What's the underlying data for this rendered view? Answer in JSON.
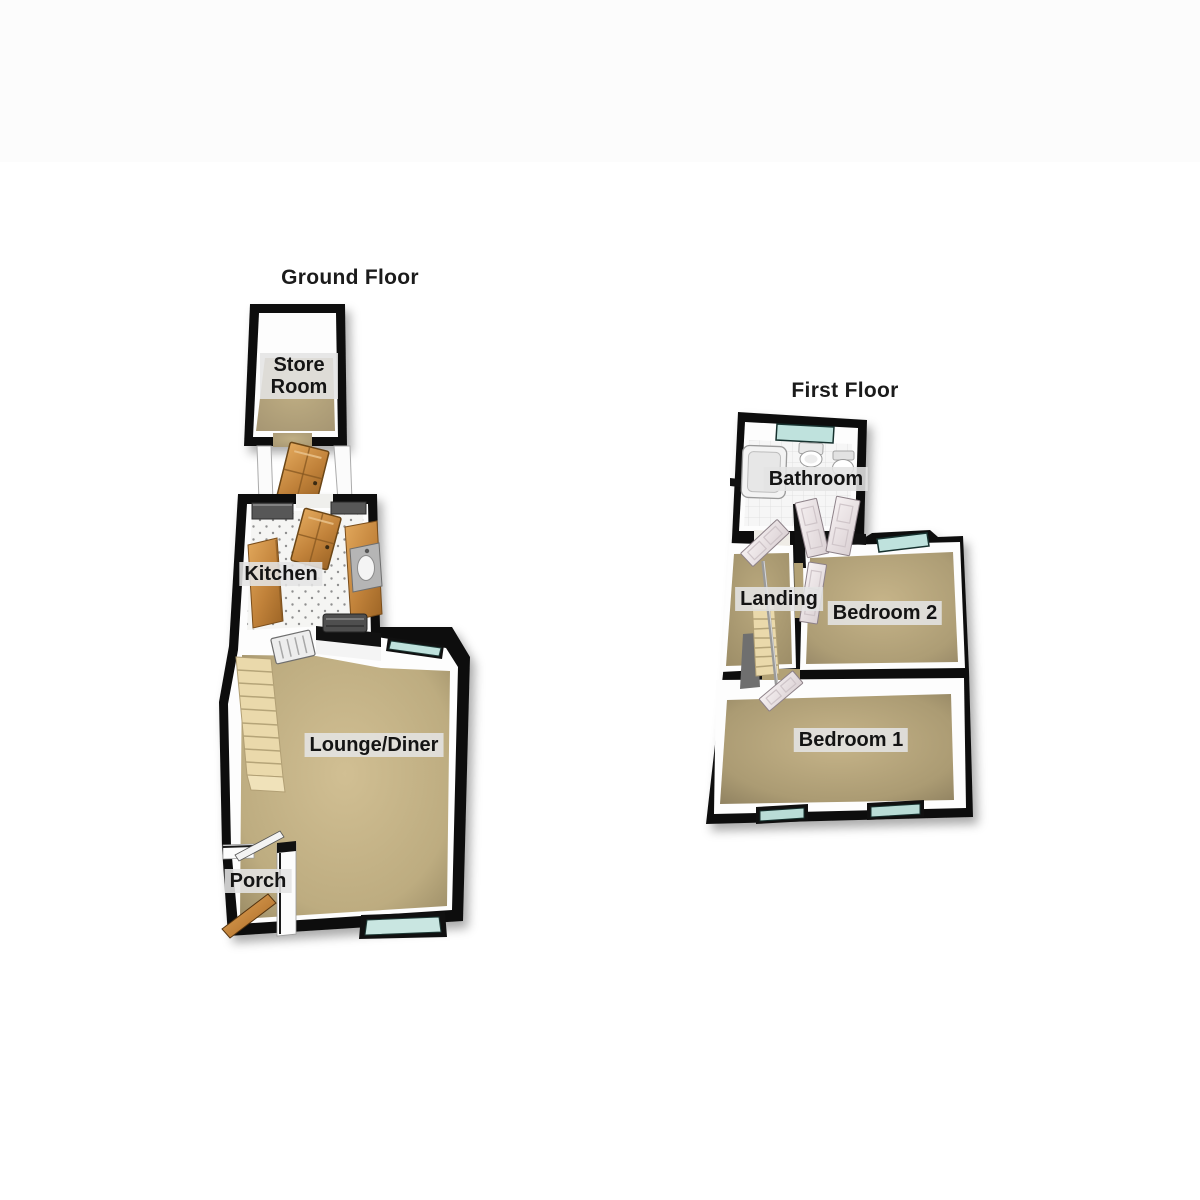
{
  "page": {
    "background": "#ffffff"
  },
  "ground_floor": {
    "title": "Ground Floor",
    "rooms": {
      "store_room": {
        "label": "Store Room"
      },
      "kitchen": {
        "label": "Kitchen"
      },
      "lounge_diner": {
        "label": "Lounge/Diner"
      },
      "porch": {
        "label": "Porch"
      }
    }
  },
  "first_floor": {
    "title": "First Floor",
    "rooms": {
      "bathroom": {
        "label": "Bathroom"
      },
      "landing": {
        "label": "Landing"
      },
      "bedroom_2": {
        "label": "Bedroom 2"
      },
      "bedroom_1": {
        "label": "Bedroom 1"
      }
    }
  },
  "colors": {
    "wall": "#111111",
    "carpet": "#b5a478",
    "kitchen_floor": "#f5f5f3",
    "bathroom_floor": "#f6f6f6",
    "window_glass": "#bfe2dd",
    "wood_door": "#c08a42",
    "white_door": "#efe8ea",
    "stairs": "#ead9ab",
    "label_bg": "#e4e4e4",
    "label_text": "#141414",
    "background": "#ffffff"
  }
}
